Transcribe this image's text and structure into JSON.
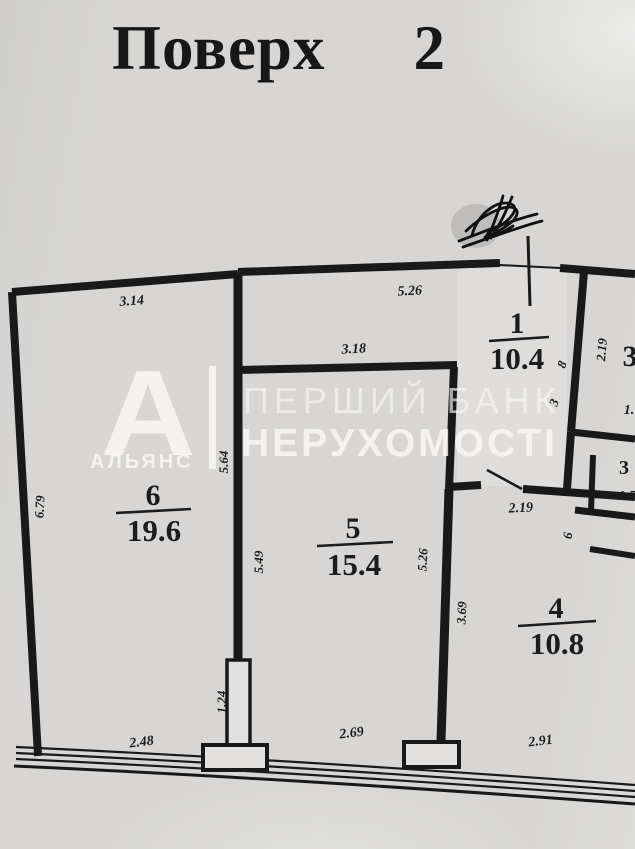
{
  "title": {
    "word": "Поверх",
    "number": "2"
  },
  "watermark": {
    "logo_letter": "А",
    "logo_caption": "АЛЬЯНС",
    "line1": "ПЕРШИЙ БАНК",
    "line2": "НЕРУХОМОСТІ"
  },
  "rooms": [
    {
      "number": "6",
      "area": "19.6"
    },
    {
      "number": "5",
      "area": "15.4"
    },
    {
      "number": "1",
      "area": "10.4"
    },
    {
      "number": "4",
      "area": "10.8"
    }
  ],
  "dimensions": [
    {
      "value": "3.14",
      "along": "room6-top"
    },
    {
      "value": "5.26",
      "along": "hall-top"
    },
    {
      "value": "3.18",
      "along": "room5-top"
    },
    {
      "value": "6.79",
      "along": "room6-left"
    },
    {
      "value": "5.64",
      "along": "room6-right"
    },
    {
      "value": "5.49",
      "along": "room5-left"
    },
    {
      "value": "5.26",
      "along": "room5-right"
    },
    {
      "value": "3.69",
      "along": "room4-left"
    },
    {
      "value": "1.24",
      "along": "pier-left"
    },
    {
      "value": "2.48",
      "along": "room6-bottom"
    },
    {
      "value": "2.69",
      "along": "room5-bottom"
    },
    {
      "value": "2.91",
      "along": "room4-bottom"
    },
    {
      "value": "2.19",
      "along": "room4-top"
    },
    {
      "value": "2.19",
      "along": "hall-right"
    }
  ],
  "partial_labels": [
    {
      "value": "8"
    },
    {
      "value": "3"
    },
    {
      "value": "3"
    },
    {
      "value": "1."
    },
    {
      "value": "3"
    },
    {
      "value": "1.5"
    },
    {
      "value": "6"
    }
  ],
  "colors": {
    "paper": "#d7d6d4",
    "ink": "#191919",
    "watermark": "#f9f8f6"
  }
}
